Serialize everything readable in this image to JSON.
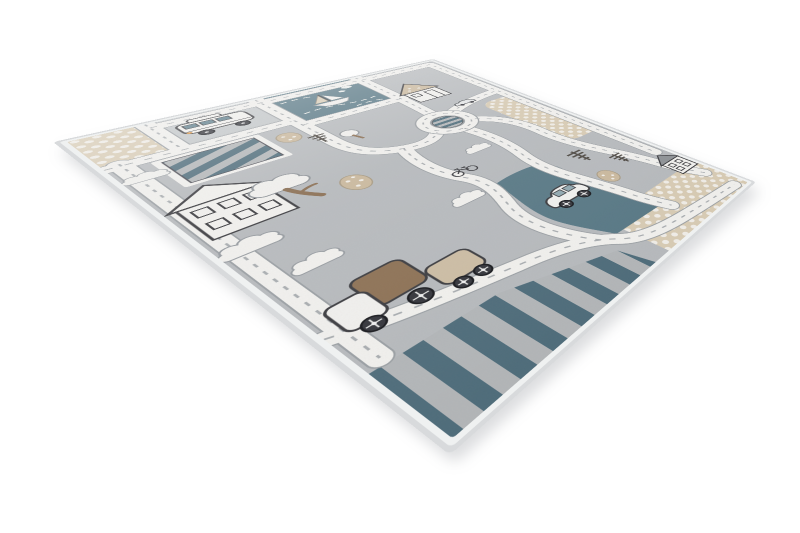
{
  "image": {
    "alt": "Children's gray street play rug with roads, roundabout, houses, trees, clouds and toy vehicles, photographed at an angle on a white background",
    "background": "#ffffff"
  },
  "colors": {
    "background": "#ffffff",
    "binding": "#d8dadc",
    "binding-inner": "#eff1f1",
    "field": "#b7babd",
    "panel": "#c4c8ca",
    "road": "#f2f1ee",
    "road-edge": "#9ba0a4",
    "dash": "#a9adb0",
    "teal": "#4e6c7a",
    "teal-light": "#587885",
    "stripe-gray": "#b3b6b8",
    "beige": "#d9ccb4",
    "dot": "#f1eee8",
    "tan": "#cbb99d",
    "brown": "#8a6e52",
    "truck-brown": "#8d7154",
    "ink": "#3b3b3f",
    "white": "#f2f1ee",
    "cloud-stroke": "#969ba0"
  },
  "rug": {
    "elements": [
      "dotted-corner-patch-top-left",
      "camper-van",
      "striped-parking-patch",
      "lake-panel",
      "sailboat",
      "roundabout",
      "road-network",
      "large-white-house",
      "tan-roof-house",
      "corner-house",
      "fluffy-tree",
      "sketch-trees",
      "dotted-bushes",
      "clouds",
      "truck-with-trailer",
      "white-car",
      "small-gray-car",
      "bicycle",
      "striped-bottom-band",
      "dotted-patch-right",
      "dotted-patch-bottom-right",
      "highway-road"
    ]
  }
}
